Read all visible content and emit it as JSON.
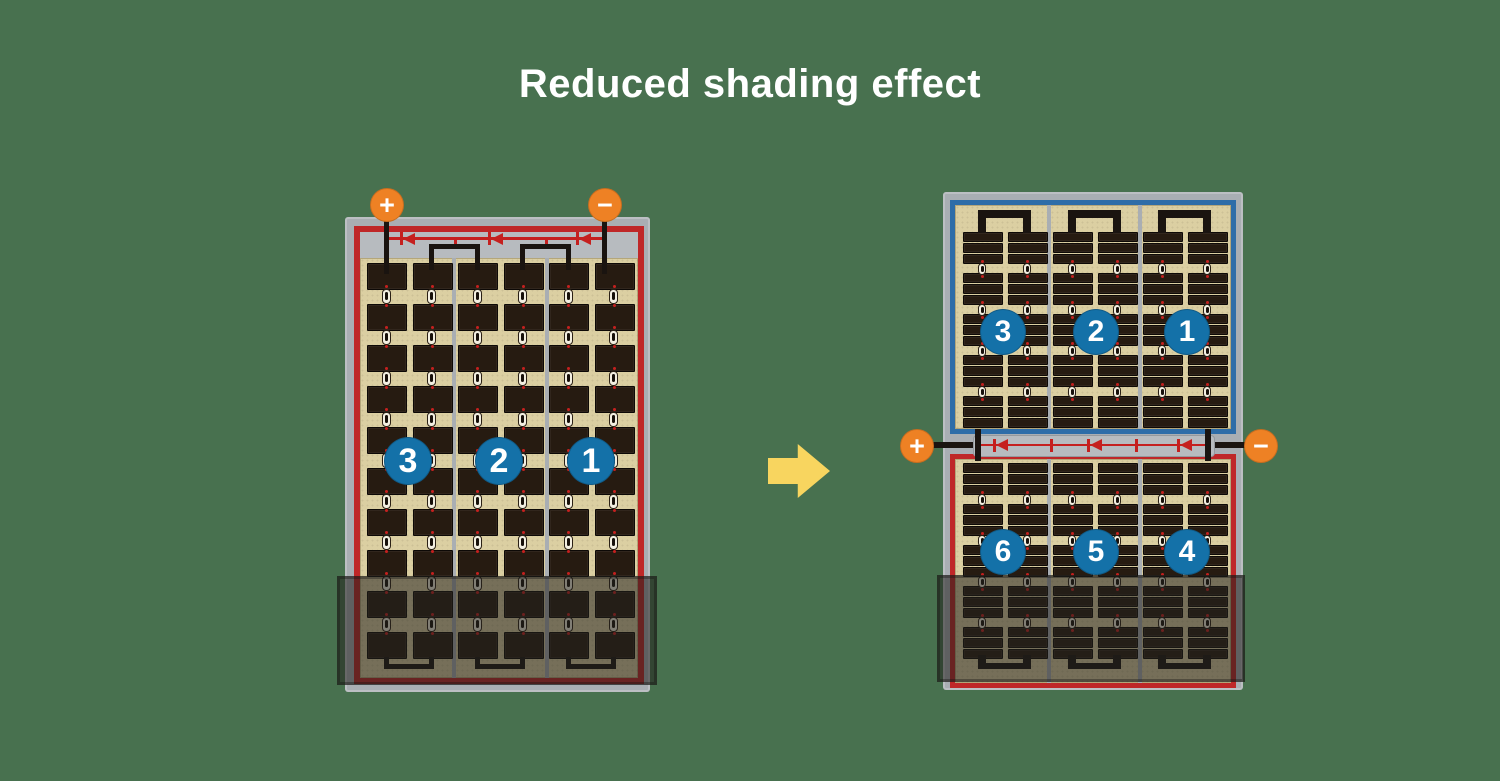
{
  "title": "Reduced shading effect",
  "colors": {
    "bg": "#48714F",
    "tan": "#DBCFA2",
    "cell": "#261B11",
    "frame": "#A9AEB3",
    "strip": "#B7BBBF",
    "red": "#BF2728",
    "blue": "#2E6DA8",
    "circle": "#1471A8",
    "orange": "#EE8124",
    "wire": "#1A1410",
    "diode": "#C5201F",
    "arrow": "#F8D55F",
    "shade": "rgba(35,33,30,0.55)"
  },
  "left_panel": {
    "terminals": {
      "positive": "+",
      "negative": "−"
    },
    "sections": [
      {
        "label": "3"
      },
      {
        "label": "2"
      },
      {
        "label": "1"
      }
    ]
  },
  "right_panel": {
    "terminals": {
      "positive": "+",
      "negative": "−"
    },
    "top_half": {
      "sections": [
        {
          "label": "3"
        },
        {
          "label": "2"
        },
        {
          "label": "1"
        }
      ]
    },
    "bottom_half": {
      "sections": [
        {
          "label": "6"
        },
        {
          "label": "5"
        },
        {
          "label": "4"
        }
      ]
    }
  }
}
